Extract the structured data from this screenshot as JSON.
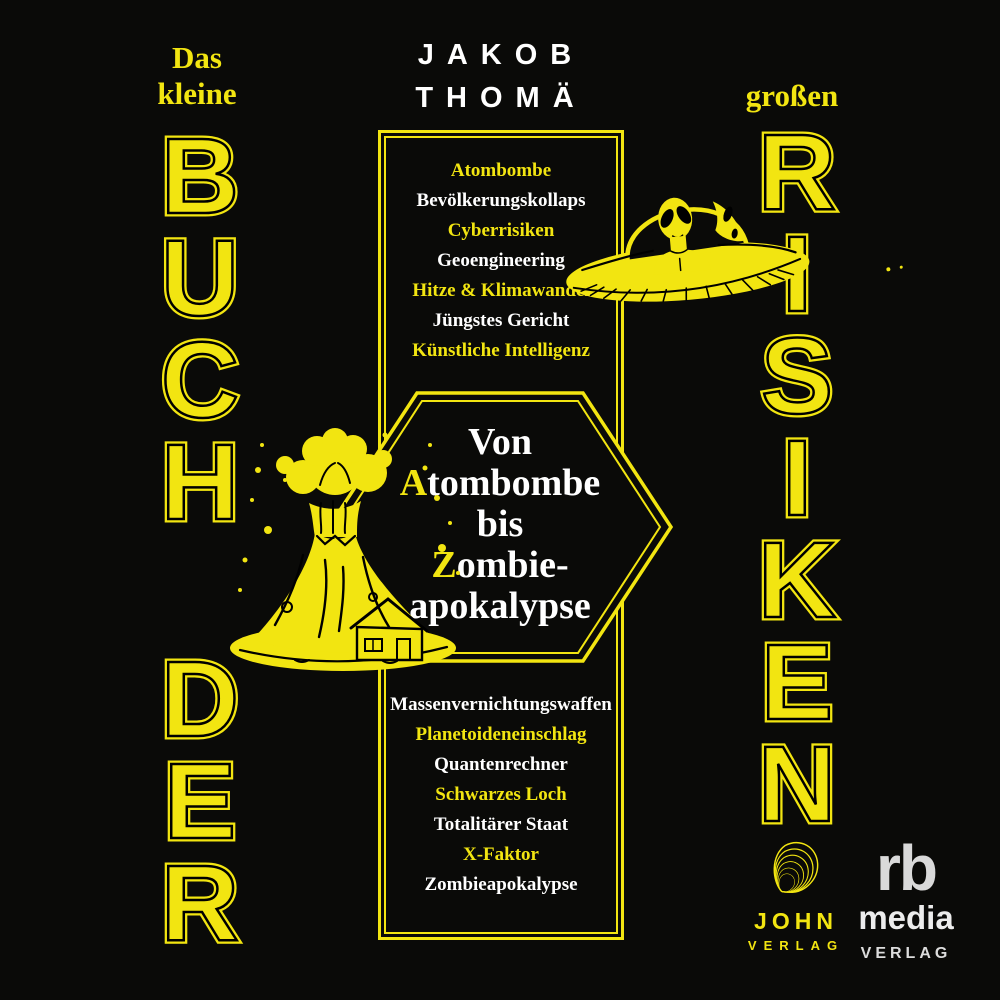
{
  "colors": {
    "yellow": "#f2e511",
    "white": "#ffffff",
    "logo_gray": "#d9d9d9",
    "background": "#0a0a08"
  },
  "header": {
    "author_line1": "JAKOB",
    "author_line2": "THOMÄ",
    "title_small_left_line1": "Das",
    "title_small_left_line2": "kleine",
    "title_small_right": "großen"
  },
  "vertical_titles": {
    "left_word_top": [
      "B",
      "U",
      "C",
      "H"
    ],
    "left_word_bottom": [
      "D",
      "E",
      "R"
    ],
    "right_word": [
      "R",
      "I",
      "S",
      "I",
      "K",
      "E",
      "N"
    ]
  },
  "risk_list_top": [
    "Atombombe",
    "Bevölkerungskollaps",
    "Cyberrisiken",
    "Geoengineering",
    "Hitze & Klimawandel",
    "Jüngstes Gericht",
    "Künstliche Intelligenz"
  ],
  "hexagon_tagline": {
    "line1": "Von",
    "line2_initial": "A",
    "line2_rest": "tombombe",
    "line3": "bis",
    "line4_initial": "Z",
    "line4_rest": "ombie-",
    "line5": "apokalypse"
  },
  "risk_list_bottom": [
    "Massenvernichtungswaffen",
    "Planetoideneinschlag",
    "Quantenrechner",
    "Schwarzes Loch",
    "Totalitärer Staat",
    "X-Faktor",
    "Zombieapokalypse"
  ],
  "publishers": {
    "john": {
      "name": "JOHN",
      "type": "VERLAG",
      "logo_icon": "shell-spiral-logo"
    },
    "rb_media": {
      "name": "rb",
      "line2": "media",
      "line3": "VERLAG"
    }
  },
  "illustrations": {
    "ufo": "ufo-alien-saucer-icon",
    "volcano": "volcano-eruption-house-icon"
  }
}
